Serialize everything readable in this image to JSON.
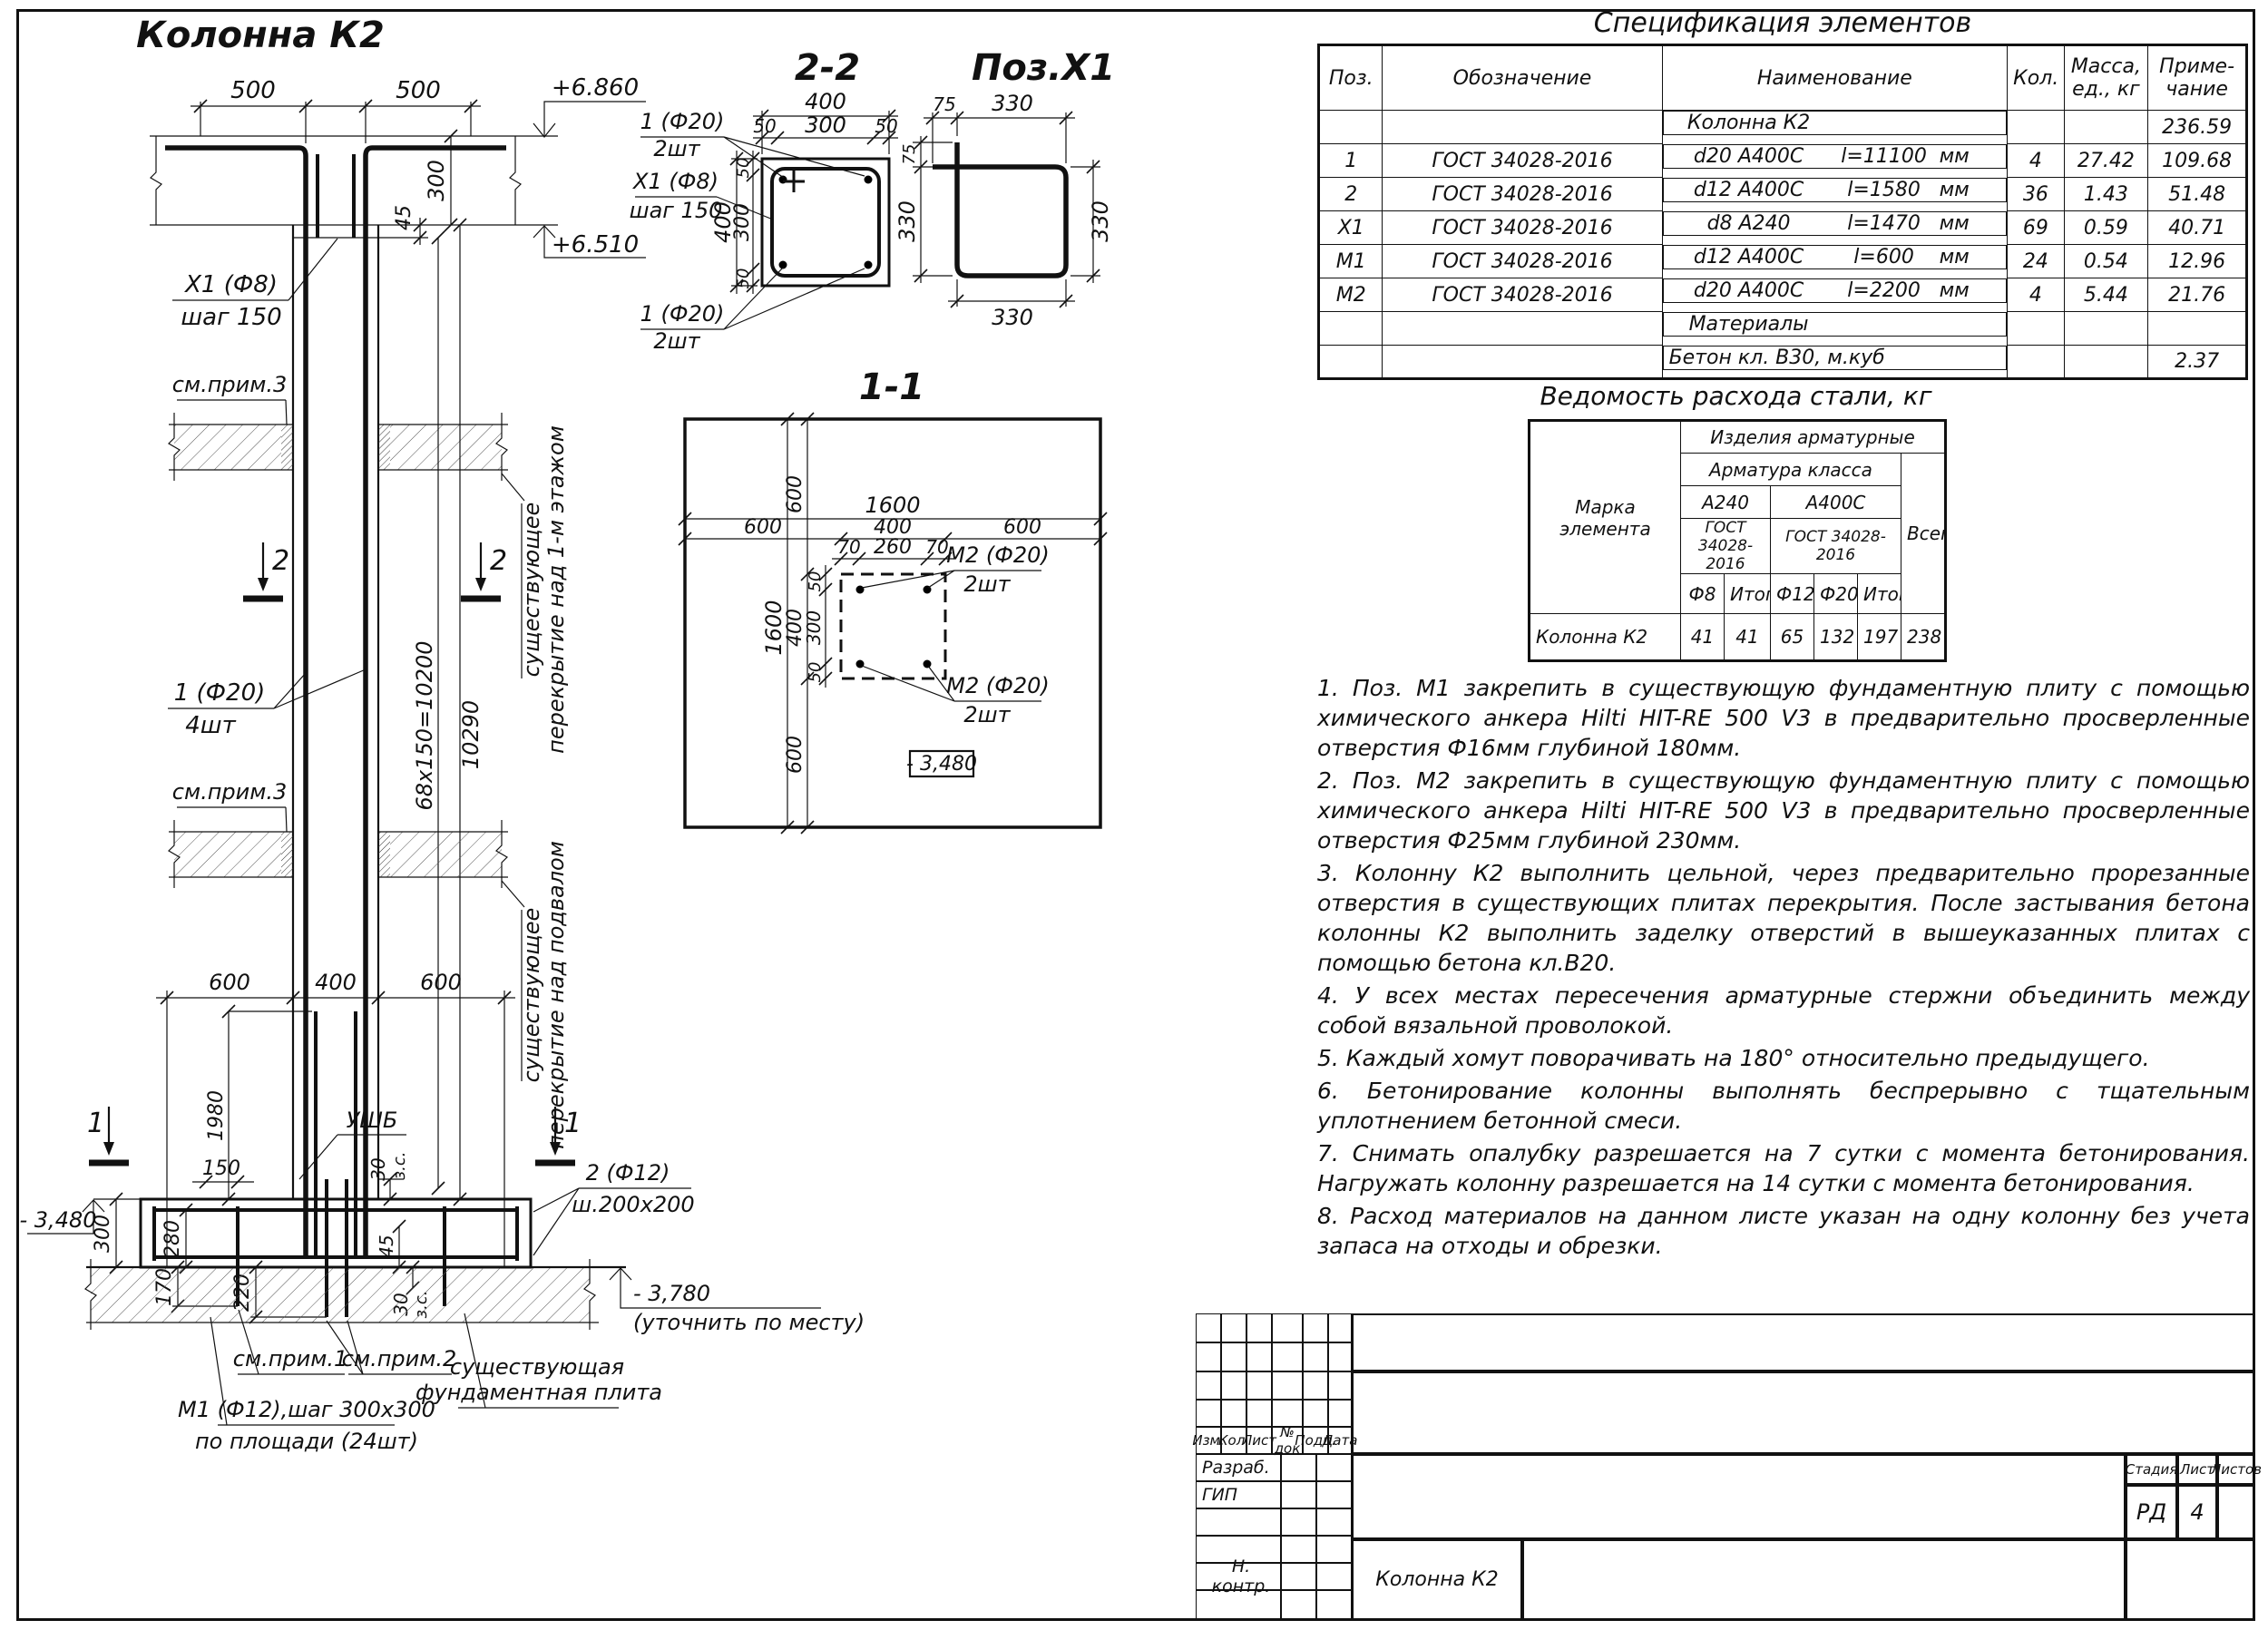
{
  "el": {
    "title": "Колонна К2",
    "d500a": "500",
    "d500b": "500",
    "lvl1": "+6.860",
    "lvl2": "+6.510",
    "d300": "300",
    "d45": "45",
    "x1a": "Х1 (Ф8)",
    "x1b": "шаг 150",
    "prim3a": "см.прим.3",
    "prim3b": "см.прим.3",
    "s2": "2",
    "s2b": "2",
    "s1": "1",
    "s1b": "1",
    "p1a": "1 (Ф20)",
    "p1b": "4шт",
    "d10200": "68х150=10200",
    "d10290": "10290",
    "slab1a": "существующее",
    "slab1b": "перекрытие над 1-м этажом",
    "slab2a": "существующее",
    "slab2b": "перекрытие над подвалом",
    "d600a": "600",
    "d400": "400",
    "d600b": "600",
    "ushb": "УШБ",
    "d1980": "1980",
    "d150": "150",
    "d30a": "30",
    "zsa": "з.с.",
    "d45b": "45",
    "p2a": "2 (Ф12)",
    "p2b": "ш.200х200",
    "lvl3": "- 3,480",
    "d300b": "300",
    "d280": "280",
    "d170": "170",
    "d220": "220",
    "d30b": "30",
    "zsb": "з.с.",
    "lvl4": "- 3,780",
    "lvl4n": "(уточнить по месту)",
    "prim1": "см.прим.1",
    "prim2": "см.прим.2",
    "fnda": "существующая",
    "fndb": "фундаментная плита",
    "m1a": "М1 (Ф12),шаг 300х300",
    "m1b": "по площади (24шт)"
  },
  "s22": {
    "title": "2-2",
    "d400t": "400",
    "d50a": "50",
    "d300t": "300",
    "d50b": "50",
    "d400l": "400",
    "d300l": "300",
    "d50c": "50",
    "d50d": "50",
    "t1": "1 (Ф20)",
    "t2": "2шт",
    "l1": "Х1 (Ф8)",
    "l2": "шаг 150",
    "b1": "1 (Ф20)",
    "b2": "2шт"
  },
  "px1": {
    "title": "Поз.Х1",
    "d75t": "75",
    "d330t": "330",
    "d75l": "75",
    "d330l": "330",
    "d330r": "330",
    "d330b": "330"
  },
  "p11": {
    "title": "1-1",
    "d1600t": "1600",
    "d600a": "600",
    "d400t": "400",
    "d600b": "600",
    "d70a": "70",
    "d260": "260",
    "d70b": "70",
    "d1600l": "1600",
    "d600c": "600",
    "d400l": "400",
    "d300": "300",
    "d50a": "50",
    "d50b": "50",
    "d600d": "600",
    "m2a1": "М2 (Ф20)",
    "m2a2": "2шт",
    "m2b1": "М2 (Ф20)",
    "m2b2": "2шт",
    "lvl": "- 3,480"
  },
  "spec": {
    "title": "Спецификация элементов",
    "h": {
      "pos": "Поз.",
      "desig": "Обозначение",
      "name": "Наименование",
      "qty": "Кол.",
      "mass": "Масса,\nед., кг",
      "note": "Приме-\nчание"
    },
    "rows": [
      {
        "pos": "",
        "desig": "",
        "grade": "Колонна К2",
        "len": "",
        "unit": "",
        "qty": "",
        "mass": "",
        "note": "236.59"
      },
      {
        "pos": "1",
        "desig": "ГОСТ 34028-2016",
        "grade": "d20 А400С",
        "len": "l=11100",
        "unit": "мм",
        "qty": "4",
        "mass": "27.42",
        "note": "109.68"
      },
      {
        "pos": "2",
        "desig": "ГОСТ 34028-2016",
        "grade": "d12 А400С",
        "len": "l=1580",
        "unit": "мм",
        "qty": "36",
        "mass": "1.43",
        "note": "51.48"
      },
      {
        "pos": "Х1",
        "desig": "ГОСТ 34028-2016",
        "grade": "d8 А240",
        "len": "l=1470",
        "unit": "мм",
        "qty": "69",
        "mass": "0.59",
        "note": "40.71"
      },
      {
        "pos": "М1",
        "desig": "ГОСТ 34028-2016",
        "grade": "d12 А400С",
        "len": "l=600",
        "unit": "мм",
        "qty": "24",
        "mass": "0.54",
        "note": "12.96"
      },
      {
        "pos": "М2",
        "desig": "ГОСТ 34028-2016",
        "grade": "d20 А400С",
        "len": "l=2200",
        "unit": "мм",
        "qty": "4",
        "mass": "5.44",
        "note": "21.76"
      },
      {
        "pos": "",
        "des": "",
        "grade": "Материалы",
        "len": "",
        "unit": "",
        "qty": "",
        "mass": "",
        "note": ""
      },
      {
        "pos": "",
        "des": "",
        "grade": "Бетон кл. В30, м.куб",
        "len": "",
        "unit": "",
        "qty": "",
        "mass": "",
        "note": "2.37"
      }
    ]
  },
  "steel": {
    "title": "Ведомость расхода стали, кг",
    "mark": "Марка\nэлемента",
    "products": "Изделия арматурные",
    "klass": "Арматура класса",
    "a240": "А240",
    "a400": "А400С",
    "gost1": "ГОСТ 34028-2016",
    "gost2": "ГОСТ 34028-2016",
    "f8": "Ф8",
    "it1": "Итого",
    "f12": "Ф12",
    "f20": "Ф20",
    "it2": "Итого",
    "vsego": "Всего",
    "row": {
      "mark": "Колонна К2",
      "f8": "41",
      "it1": "41",
      "f12": "65",
      "f20": "132",
      "it2": "197",
      "vsego": "238"
    }
  },
  "notes": [
    "1. Поз. М1 закрепить в существующую фундаментную плиту с помощью химического анкера Hilti HIT-RE 500 V3 в предварительно просверленные отверстия Ф16мм глубиной 180мм.",
    "2. Поз. М2 закрепить в существующую фундаментную плиту с помощью химического анкера Hilti HIT-RE 500 V3 в предварительно просверленные отверстия Ф25мм глубиной 230мм.",
    "3. Колонну К2 выполнить цельной, через предварительно прорезанные отверстия в существующих плитах перекрытия. После застывания бетона колонны К2 выполнить заделку отверстий в вышеуказанных плитах с помощью бетона кл.В20.",
    "4. У всех местах пересечения арматурные стержни объединить между собой вязальной проволокой.",
    "5. Каждый хомут поворачивать на 180° относительно предыдущего.",
    "6. Бетонирование колонны выполнять беспрерывно с тщательным уплотнением бетонной смеси.",
    "7. Снимать опалубку разрешается на 7 сутки с момента бетонирования. Нагружать колонну разрешается на 14 сутки с момента бетонирования.",
    "8. Расход материалов на данном листе указан на одну колонну без учета запаса на отходы и обрезки."
  ],
  "tb": {
    "c1": "Изм.",
    "c2": "Кол.",
    "c3": "Лист",
    "c4": "№ док",
    "c5": "Подп.",
    "c6": "Дата",
    "r1": "Разраб.",
    "r2": "ГИП",
    "r3": "Н. контр.",
    "stage_l": "Стадия",
    "sheet_l": "Лист",
    "sheets_l": "Листов",
    "stage": "РД",
    "sheet": "4",
    "name": "Колонна К2"
  }
}
